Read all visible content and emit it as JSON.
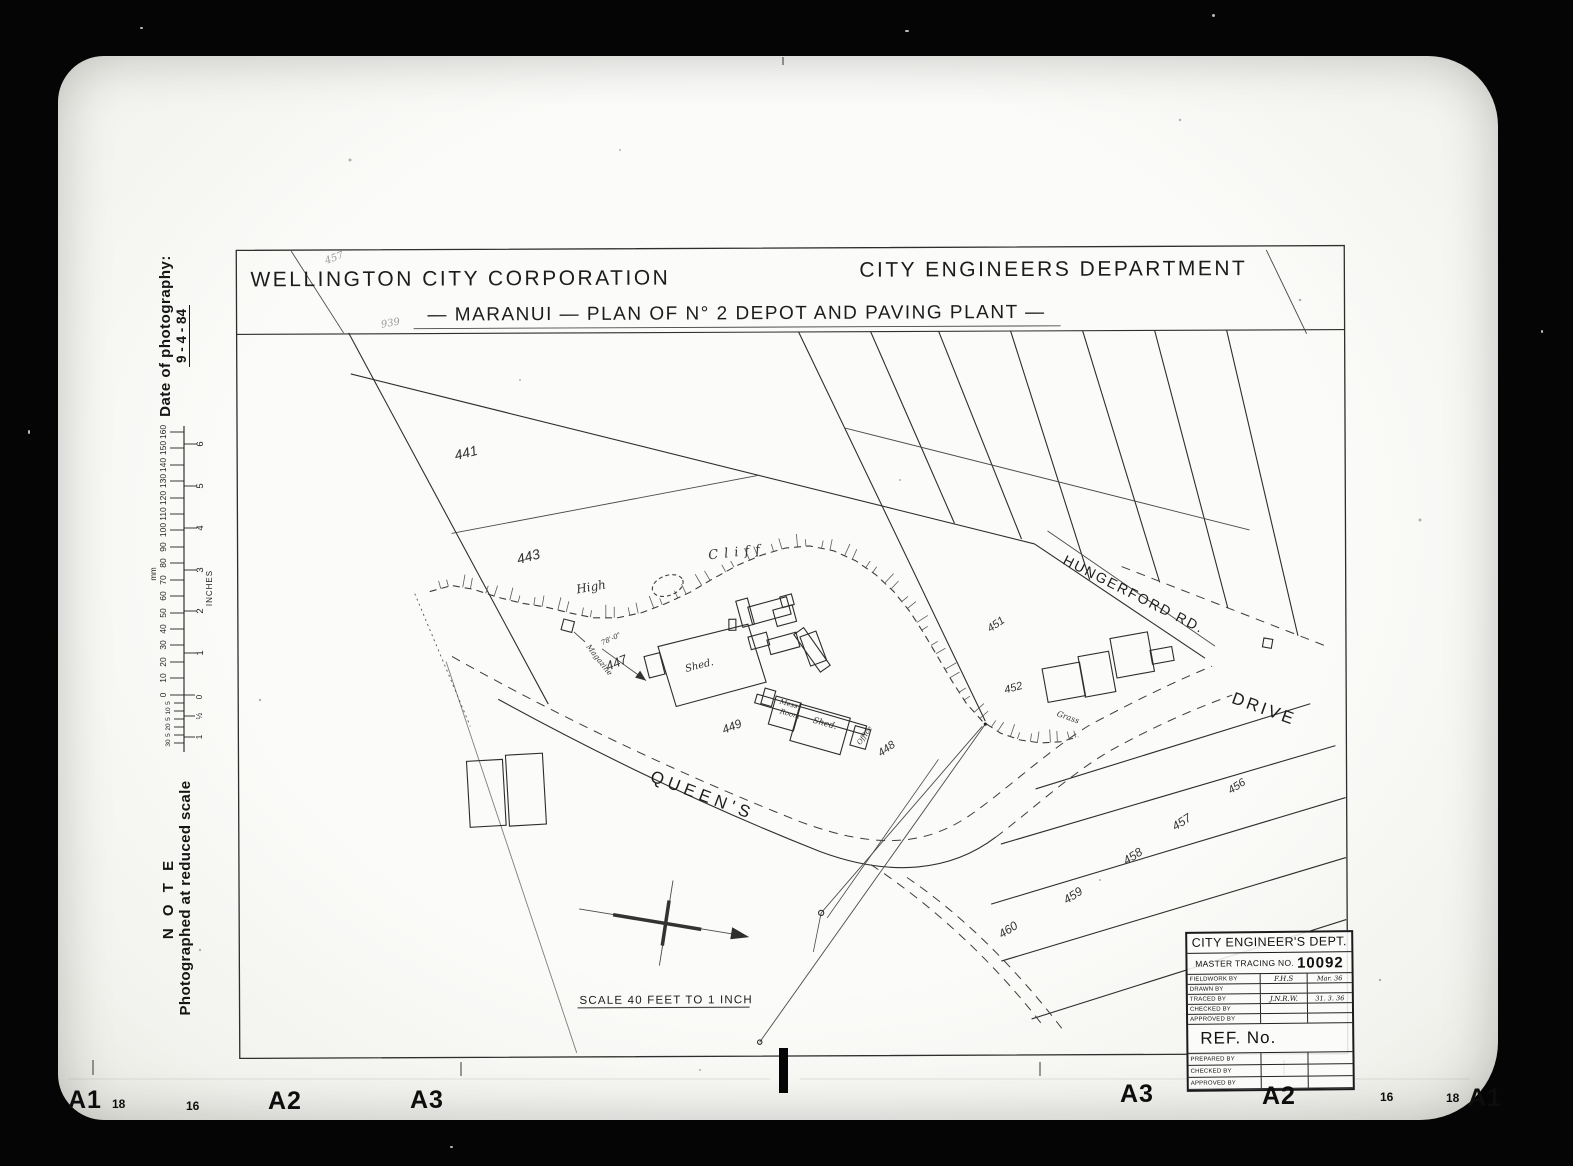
{
  "header": {
    "corporation": "WELLINGTON  CITY  CORPORATION",
    "department": "CITY  ENGINEERS  DEPARTMENT",
    "subtitle": "— MARANUI — PLAN  OF  N° 2  DEPOT  AND  PAVING  PLANT —"
  },
  "margin": {
    "photo_date_label": "Date of photography:",
    "photo_date_value": "9 - 4 - 84",
    "note_heading": "N O T E",
    "note_body": "Photographed at reduced scale",
    "ruler": {
      "mm_unit": "mm",
      "in_unit": "INCHES",
      "mm": [
        "160",
        "150",
        "140",
        "130",
        "120",
        "110",
        "100",
        "90",
        "80",
        "70",
        "60",
        "50",
        "40",
        "30",
        "20",
        "10",
        "0"
      ],
      "mm_minor": [
        "5",
        "10",
        "5",
        "20",
        "5",
        "30"
      ],
      "inches": [
        "6",
        "5",
        "4",
        "3",
        "2",
        "1"
      ],
      "in_zero": "0",
      "in_half": "½",
      "in_one": "1"
    }
  },
  "plan": {
    "lot441": "441",
    "lot443": "443",
    "lot447": "447",
    "lot448": "448",
    "lot449": "449",
    "lot451": "451",
    "lot452": "452",
    "lot456": "456",
    "lot457": "457",
    "lot458": "458",
    "lot459": "459",
    "lot460": "460",
    "queens": "QUEEN'S",
    "drive": "DRIVE",
    "hungerford": "HUNGERFORD  RD.",
    "high": "High",
    "cliff": "Cliff",
    "grass": "Grass",
    "shed_main": "Shed.",
    "shed_small": "Shed.",
    "mess_line1": "Mess",
    "mess_line2": "Room",
    "office": "Office",
    "magazine": "Magazine",
    "dim_shed": "78'-0\"",
    "scale_text": "SCALE  40  FEET   TO  1  INCH",
    "pencil_a": "457",
    "pencil_b": "939"
  },
  "titleblock": {
    "dept": "CITY ENGINEER'S DEPT.",
    "tracing_label": "Master Tracing No.",
    "tracing_no": "10092",
    "rows": [
      {
        "label": "Fieldwork by",
        "c1": "F.H.S",
        "c2": "Mar. 36"
      },
      {
        "label": "Drawn by",
        "c1": "",
        "c2": ""
      },
      {
        "label": "Traced by",
        "c1": "J.N.R.W.",
        "c2": "31. 3. 36"
      },
      {
        "label": "Checked by",
        "c1": "",
        "c2": ""
      },
      {
        "label": "Approved by",
        "c1": "",
        "c2": ""
      }
    ],
    "ref_label": "REF. No.",
    "rows2": [
      {
        "label": "Prepared by"
      },
      {
        "label": "Checked by"
      },
      {
        "label": "Approved by"
      }
    ]
  },
  "frame": {
    "bl": [
      "A1",
      "18",
      "16",
      "A2",
      "A3"
    ],
    "br": [
      "A3",
      "A2",
      "16",
      "18",
      "A1"
    ]
  }
}
